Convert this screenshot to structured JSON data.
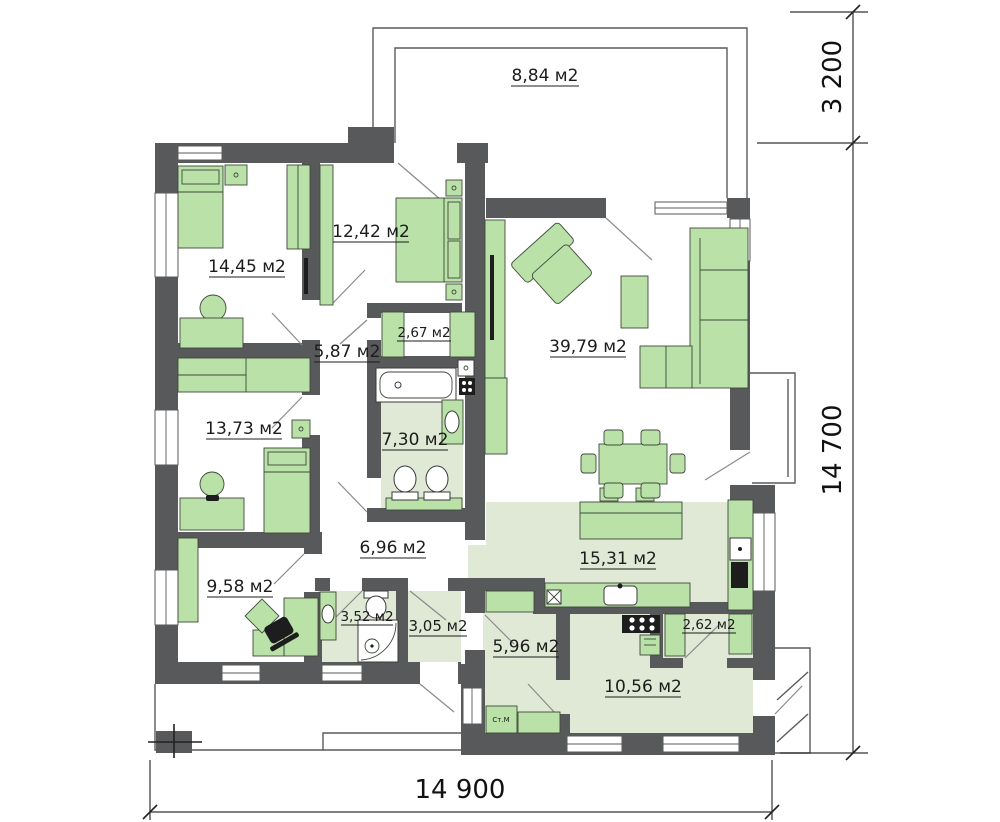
{
  "plan": {
    "rooms": [
      {
        "key": "terrace",
        "label": "8,84 м2"
      },
      {
        "key": "bedroom-1",
        "label": "14,45 м2"
      },
      {
        "key": "bedroom-2",
        "label": "12,42 м2"
      },
      {
        "key": "closet",
        "label": "2,67 м2"
      },
      {
        "key": "hallway-1",
        "label": "5,87 м2"
      },
      {
        "key": "living-room",
        "label": "39,79 м2"
      },
      {
        "key": "bedroom-3",
        "label": "13,73 м2"
      },
      {
        "key": "bathroom",
        "label": "7,30 м2"
      },
      {
        "key": "corridor",
        "label": "6,96 м2"
      },
      {
        "key": "kitchen",
        "label": "15,31 м2"
      },
      {
        "key": "office",
        "label": "9,58 м2"
      },
      {
        "key": "shower-room",
        "label": "3,52 м2"
      },
      {
        "key": "entry-hall",
        "label": "3,05 м2"
      },
      {
        "key": "utility-room",
        "label": "5,96 м2"
      },
      {
        "key": "pantry",
        "label": "2,62 м2"
      },
      {
        "key": "workshop",
        "label": "10,56 м2"
      }
    ],
    "dimensions": {
      "bottom": "14 900",
      "right_total": "14 700",
      "right_terrace": "3 200"
    },
    "appliances": {
      "washing_machine": "Ст.М"
    },
    "colors": {
      "wall": "#58595b",
      "furniture": "#b9e1a8",
      "floor_shade": "#dfe9d6"
    }
  }
}
